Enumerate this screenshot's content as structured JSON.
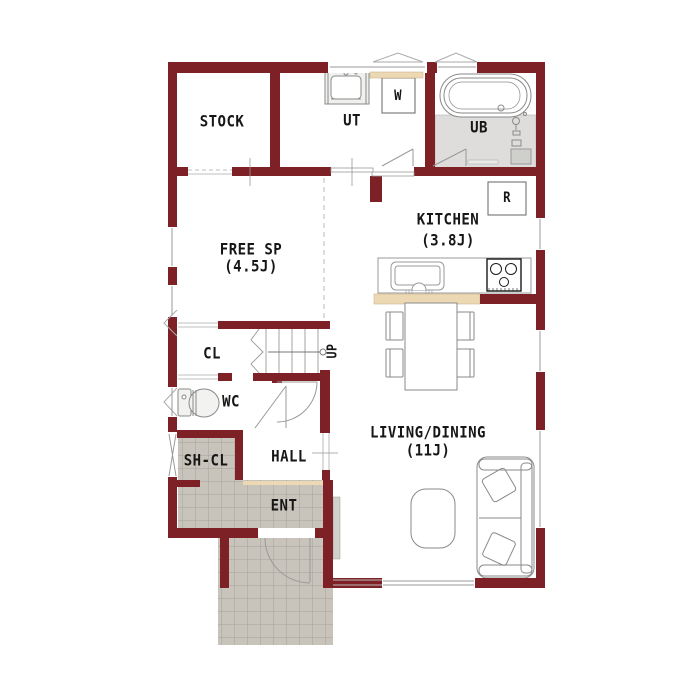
{
  "plan": {
    "colors": {
      "wall": "#7e2127",
      "entrance_tile": "#c8c4bc",
      "tile_grout": "#a8a299",
      "counter_wood": "#ecd9b4",
      "bath_floor": "#dedddb",
      "fixture_outline": "#8a8a8a",
      "text": "#161616"
    },
    "rooms": {
      "stock": {
        "label": "STOCK"
      },
      "ut": {
        "label": "UT"
      },
      "ub": {
        "label": "UB"
      },
      "kitchen": {
        "label": "KITCHEN",
        "size": "(3.8J)"
      },
      "free_sp": {
        "label": "FREE SP",
        "size": "(4.5J)"
      },
      "cl": {
        "label": "CL"
      },
      "wc": {
        "label": "WC"
      },
      "sh_cl": {
        "label": "SH-CL"
      },
      "hall": {
        "label": "HALL"
      },
      "ent": {
        "label": "ENT"
      },
      "living": {
        "label": "LIVING/DINING",
        "size": "(11J)"
      }
    },
    "appliances": {
      "washer": {
        "label": "W"
      },
      "fridge": {
        "label": "R"
      }
    },
    "stairs": {
      "direction_label": "UP"
    }
  }
}
